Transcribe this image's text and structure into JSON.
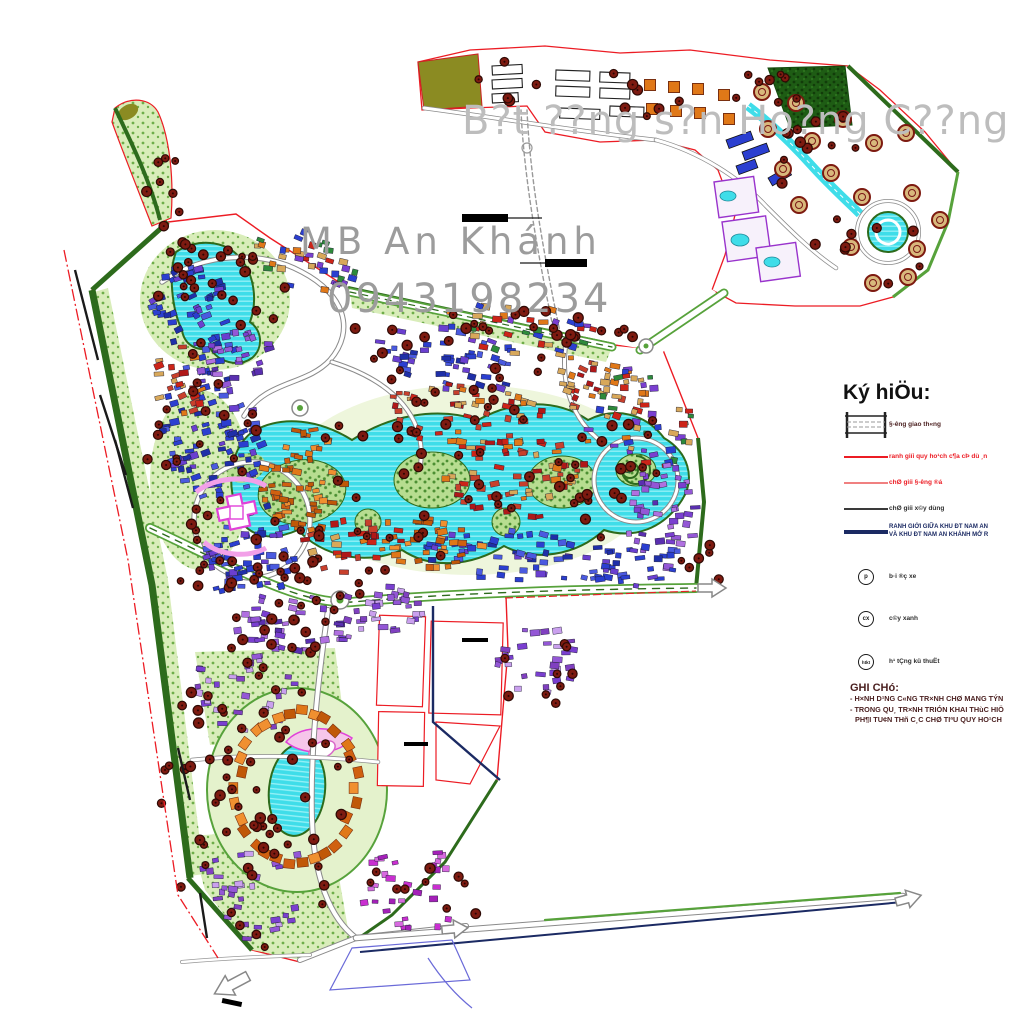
{
  "watermarks": {
    "line1": "B?t ??ng s?n Ho?ng C??ng",
    "line2": "MB An Khánh",
    "line3": "0943198234"
  },
  "legend": {
    "title": "Ký hiÖu:",
    "items": [
      {
        "icon": "road-symbol",
        "label": "§-êng giao th«ng"
      },
      {
        "icon": "red-line",
        "label": "ranh giíi quy ho¹ch c¶a cÞ dù ¸n"
      },
      {
        "icon": "pink-line",
        "label": "chØ giíi §-êng ®á"
      },
      {
        "icon": "black-line",
        "label": "chØ giíi x©y dùng"
      },
      {
        "icon": "navy-line",
        "label": "RANH GIỚI GIỮA KHU ĐT NAM AN",
        "label2": "VÀ KHU ĐT NAM AN KHÁNH MỞ R"
      },
      {
        "icon": "circle-p",
        "symbol": "p",
        "label": "b·i ®ç xe"
      },
      {
        "icon": "circle-cx",
        "symbol": "cx",
        "label": "c©y xanh"
      },
      {
        "icon": "circle-htkt",
        "symbol": "htkt",
        "label": "h¹ tÇng kü thuËt"
      }
    ]
  },
  "notes": {
    "title": "GHI CHó:",
    "line1": "- H×NH D¹NG C«NG TR×NH CHØ MANG TÝN",
    "line2": "- TRONG QU¸ TR×NH TRIÓN KHAI THùC HIÖ",
    "line3": "PH¶I TU¢N THñ C¸C CHØ TIªU QUY HO¹CH"
  },
  "map": {
    "colors": {
      "boundary_red": "#ec1c24",
      "boundary_pink": "#f08080",
      "boundary_navy": "#1b2a63",
      "lake_cyan": "#3fdde9",
      "lake_stripe": "#96f1f7",
      "olive": "#8b8b22",
      "forest_green": "#1e5c14",
      "light_green": "#d9edba",
      "mid_green": "#57a23b",
      "dark_green": "#2d6b1c",
      "road_casing": "#8a8a8a",
      "tree_fill": "#7d1a10",
      "tree_stroke": "#2e0a05",
      "pad_tan": "#d8b87c",
      "orange_bldg": "#e07818",
      "navy_bldg": "#2b3fd0",
      "magenta_line": "#e042d8",
      "watermark_gray": "#b5b5b5"
    },
    "palettes": {
      "navy": [
        "#2b3fd0",
        "#1f2fa8",
        "#4a5ae0",
        "#2b3fd0",
        "#6a3fd0"
      ],
      "purple": [
        "#7a3fd0",
        "#9457d6",
        "#b070e0",
        "#5a2fb0"
      ],
      "violet": [
        "#9457d6",
        "#7a3fd0",
        "#caa0ee",
        "#8040c0"
      ],
      "magenta": [
        "#c92fd0",
        "#a420b8",
        "#d86ae0"
      ],
      "orange": [
        "#e07818",
        "#d06010",
        "#f09030",
        "#c05808"
      ],
      "redtan": [
        "#cc2418",
        "#d8a85a",
        "#e07818",
        "#b01818",
        "#c8402c"
      ],
      "mixed": [
        "#2b3fd0",
        "#cc2418",
        "#e07818",
        "#7a3fd0",
        "#2d8a3a",
        "#d8a85a"
      ]
    },
    "clusters": [
      [
        196,
        318,
        42,
        55,
        -18,
        55,
        "navy"
      ],
      [
        212,
        432,
        52,
        72,
        -12,
        85,
        "navy"
      ],
      [
        252,
        556,
        46,
        55,
        -8,
        60,
        "navy"
      ],
      [
        238,
        360,
        40,
        28,
        -10,
        28,
        "purple"
      ],
      [
        300,
        262,
        58,
        30,
        12,
        38,
        "mixed"
      ],
      [
        298,
        480,
        50,
        55,
        0,
        55,
        "orange"
      ],
      [
        296,
        622,
        66,
        30,
        4,
        40,
        "purple"
      ],
      [
        382,
        612,
        44,
        26,
        4,
        30,
        "violet"
      ],
      [
        452,
        358,
        75,
        32,
        9,
        48,
        "navy"
      ],
      [
        468,
        420,
        85,
        35,
        7,
        55,
        "redtan"
      ],
      [
        528,
        330,
        85,
        28,
        10,
        40,
        "mixed"
      ],
      [
        520,
        478,
        75,
        40,
        0,
        55,
        "redtan"
      ],
      [
        518,
        556,
        95,
        26,
        4,
        55,
        "navy"
      ],
      [
        600,
        390,
        48,
        28,
        14,
        32,
        "redtan"
      ],
      [
        638,
        422,
        55,
        55,
        0,
        50,
        "mixed"
      ],
      [
        662,
        518,
        36,
        55,
        0,
        42,
        "purple"
      ],
      [
        634,
        564,
        55,
        22,
        0,
        30,
        "navy"
      ],
      [
        178,
        382,
        26,
        38,
        -14,
        22,
        "redtan"
      ],
      [
        248,
        690,
        58,
        42,
        0,
        30,
        "violet"
      ],
      [
        252,
        888,
        60,
        52,
        0,
        34,
        "violet"
      ],
      [
        418,
        888,
        58,
        42,
        0,
        30,
        "magenta"
      ],
      [
        536,
        660,
        42,
        36,
        0,
        28,
        "violet"
      ],
      [
        350,
        545,
        60,
        28,
        -6,
        35,
        "redtan"
      ],
      [
        430,
        545,
        55,
        25,
        0,
        30,
        "orange"
      ]
    ],
    "ring": {
      "cx": 296,
      "cy": 788,
      "rx": 60,
      "ry": 76,
      "n": 30,
      "palette": "orange"
    },
    "tree_zones": [
      [
        215,
        295,
        75,
        60,
        22
      ],
      [
        205,
        470,
        60,
        95,
        26
      ],
      [
        260,
        585,
        80,
        40,
        16
      ],
      [
        345,
        555,
        110,
        50,
        22
      ],
      [
        470,
        450,
        150,
        75,
        34
      ],
      [
        620,
        470,
        75,
        70,
        20
      ],
      [
        450,
        350,
        120,
        45,
        20
      ],
      [
        560,
        330,
        90,
        30,
        14
      ],
      [
        300,
        625,
        70,
        35,
        12
      ],
      [
        250,
        695,
        70,
        50,
        16
      ],
      [
        255,
        885,
        75,
        65,
        18
      ],
      [
        297,
        790,
        85,
        95,
        20
      ],
      [
        430,
        885,
        65,
        45,
        10
      ],
      [
        535,
        668,
        48,
        40,
        9
      ],
      [
        640,
        95,
        55,
        28,
        7
      ],
      [
        765,
        100,
        45,
        30,
        8
      ],
      [
        825,
        160,
        55,
        50,
        11
      ],
      [
        868,
        255,
        55,
        45,
        9
      ],
      [
        500,
        82,
        38,
        22,
        5
      ],
      [
        178,
        300,
        30,
        90,
        10
      ],
      [
        160,
        180,
        18,
        45,
        6
      ],
      [
        700,
        560,
        30,
        30,
        6
      ],
      [
        200,
        790,
        40,
        60,
        10
      ]
    ],
    "pads": [
      [
        762,
        92
      ],
      [
        796,
        103
      ],
      [
        768,
        129
      ],
      [
        812,
        141
      ],
      [
        843,
        119
      ],
      [
        874,
        143
      ],
      [
        906,
        133
      ],
      [
        783,
        169
      ],
      [
        831,
        173
      ],
      [
        862,
        197
      ],
      [
        912,
        193
      ],
      [
        799,
        205
      ],
      [
        851,
        247
      ],
      [
        917,
        249
      ],
      [
        873,
        283
      ],
      [
        908,
        277
      ],
      [
        940,
        220
      ]
    ],
    "orange_squares": [
      [
        650,
        85
      ],
      [
        674,
        87
      ],
      [
        698,
        89
      ],
      [
        652,
        109
      ],
      [
        676,
        111
      ],
      [
        700,
        113
      ],
      [
        724,
        95
      ],
      [
        729,
        119
      ]
    ],
    "white_blocks": [
      [
        492,
        66,
        30,
        9,
        -3
      ],
      [
        492,
        80,
        30,
        9,
        -3
      ],
      [
        492,
        94,
        26,
        9,
        -3
      ],
      [
        556,
        70,
        34,
        10,
        2
      ],
      [
        556,
        86,
        34,
        10,
        2
      ],
      [
        600,
        72,
        30,
        10,
        2
      ],
      [
        600,
        88,
        30,
        10,
        2
      ],
      [
        560,
        108,
        40,
        10,
        2
      ],
      [
        610,
        106,
        34,
        10,
        2
      ]
    ],
    "navy_blocks": [
      [
        726,
        140,
        26,
        9,
        -20
      ],
      [
        742,
        152,
        26,
        9,
        -20
      ],
      [
        736,
        166,
        20,
        9,
        -20
      ],
      [
        768,
        178,
        22,
        9,
        -30
      ]
    ],
    "pools": [
      [
        728,
        196,
        8,
        5
      ],
      [
        740,
        240,
        9,
        6
      ],
      [
        772,
        262,
        8,
        5
      ]
    ]
  }
}
